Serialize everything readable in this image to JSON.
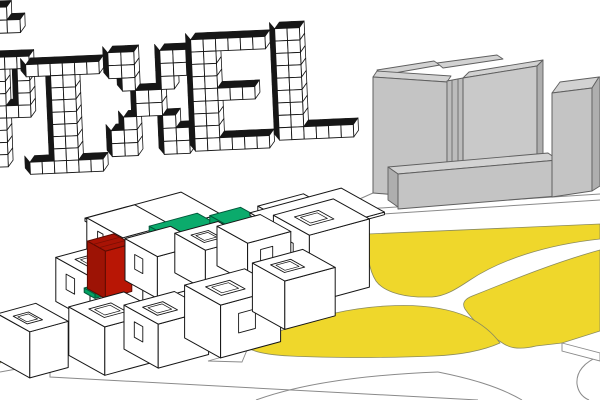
{
  "title": {
    "text": "PIXEL",
    "glyphs": {
      "P": [
        "XXXX",
        "XX.X",
        "XX.X",
        "XX.X",
        "XXXX",
        "XX..",
        "XX..",
        "XX..",
        "XX.."
      ],
      "I": [
        "XXXXXX",
        "..XX..",
        "..XX..",
        "..XX..",
        "..XX..",
        "..XX..",
        "..XX..",
        "..XX..",
        "XXXXXX"
      ],
      "X": [
        "XX..XX",
        "XX..XX",
        ".X..X.",
        "..XX..",
        "..XX..",
        ".X..X.",
        "XX..XX",
        "XX..XX"
      ],
      "E": [
        "XXXXXX",
        "XX....",
        "XX....",
        "XX....",
        "XXXXX.",
        "XX....",
        "XX....",
        "XX....",
        "XXXXXX"
      ],
      "L": [
        "XX....",
        "XX....",
        "XX....",
        "XX....",
        "XX....",
        "XX....",
        "XX....",
        "XX....",
        "XXXXXX"
      ]
    },
    "fragment": [
      "X.",
      "XX"
    ]
  },
  "colors": {
    "ink": "#161616",
    "line": "#8a8a8a",
    "lawn": "#efd72b",
    "lawn_edge": "#8b8b5e",
    "gray_top": "#d2d2d2",
    "gray_face": "#c4c4c4",
    "gray_face2": "#c9c9c9",
    "gray_pilaster": "#bcbcbc",
    "gray_side": "#aeaeae",
    "gray_edge": "#5f5f5f",
    "green_top": "#0bab6c",
    "green_front": "#02a061",
    "green_side": "#018a52",
    "green_recess": "#018a52",
    "green_edge": "#02573a",
    "red_top": "#a81305",
    "red_front": "#9d1305",
    "red_side": "#b81605",
    "red_edge": "#5f0b02",
    "white": "#ffffff"
  },
  "scene": {
    "units": [
      {
        "id": "roof-deck-left",
        "color": "white",
        "i": 1.6,
        "j": -0.55,
        "k": 1.75,
        "si": 2.0,
        "sj": 1.1,
        "sk": 0.07
      },
      {
        "id": "module-back-left",
        "color": "white",
        "i": 1.3,
        "j": -0.1,
        "k": 1.0,
        "si": 1.0,
        "sj": 1.0,
        "sk": 1.12,
        "window": "front-narrow"
      },
      {
        "id": "unit-green-annex",
        "color": "green",
        "i": 2.1,
        "j": 0.2,
        "k": 0.8,
        "si": 0.45,
        "sj": 0.6,
        "sk": 0.5
      },
      {
        "id": "unit-green-1",
        "color": "green",
        "i": 2.45,
        "j": 0.1,
        "k": 0.78,
        "si": 1.0,
        "sj": 0.9,
        "sk": 0.9,
        "window": "right-big"
      },
      {
        "id": "unit-green-2",
        "color": "green",
        "i": 3.6,
        "j": 0.25,
        "k": 0.6,
        "si": 0.64,
        "sj": 0.8,
        "sk": 1.05
      },
      {
        "id": "unit-green-3",
        "color": "green",
        "i": 4.25,
        "j": 0.3,
        "k": 0.6,
        "si": 0.6,
        "sj": 0.75,
        "sk": 0.62,
        "roof": "recessed"
      },
      {
        "id": "module-back-right",
        "color": "white",
        "i": 4.9,
        "j": -0.15,
        "k": 0.35,
        "si": 0.95,
        "sj": 0.9,
        "sk": 0.95,
        "roof": "open"
      },
      {
        "id": "roof-deck-right",
        "color": "white",
        "i": 5.0,
        "j": -0.5,
        "k": 0.9,
        "si": 1.9,
        "sj": 1.2,
        "sk": 0.06
      },
      {
        "id": "module-right-top",
        "color": "white",
        "i": 5.0,
        "j": 0.15,
        "k": -0.35,
        "si": 1.25,
        "sj": 1.0,
        "sk": 1.55,
        "window": "front-small",
        "roof": "open"
      },
      {
        "id": "module-mid-left",
        "color": "white",
        "i": 0.28,
        "j": 0.4,
        "k": 0.75,
        "si": 1.1,
        "sj": 0.95,
        "sk": 1.0,
        "window": "front-small",
        "roof": "open"
      },
      {
        "id": "unit-green-patch",
        "color": "green",
        "i": 0.78,
        "j": 0.52,
        "k": 0.86,
        "si": 0.16,
        "sj": 0.3,
        "sk": 0.1
      },
      {
        "id": "unit-red",
        "color": "red",
        "i": 0.9,
        "j": 0.45,
        "k": 0.88,
        "si": 0.55,
        "sj": 0.5,
        "sk": 1.08
      },
      {
        "id": "module-mid-2",
        "color": "white",
        "i": 1.72,
        "j": 0.4,
        "k": 0.8,
        "si": 0.95,
        "sj": 0.9,
        "sk": 0.95,
        "window": "front-small"
      },
      {
        "id": "module-mid-3",
        "color": "white",
        "i": 2.72,
        "j": 0.45,
        "k": 0.7,
        "si": 0.9,
        "sj": 0.85,
        "sk": 0.9,
        "roof": "open"
      },
      {
        "id": "module-mid-4",
        "color": "white",
        "i": 3.6,
        "j": 0.45,
        "k": 0.6,
        "si": 0.9,
        "sj": 0.85,
        "sk": 0.9,
        "window": "right-small"
      },
      {
        "id": "module-front-0",
        "color": "white",
        "i": 0.1,
        "j": 1.0,
        "k": -0.15,
        "si": 1.15,
        "sj": 1.0,
        "sk": 1.1,
        "roof": "open"
      },
      {
        "id": "module-front-left",
        "color": "white",
        "i": -1.35,
        "j": 0.95,
        "k": 0.15,
        "si": 0.8,
        "sj": 0.9,
        "sk": 1.05,
        "roof": "open"
      },
      {
        "id": "module-front-1",
        "color": "white",
        "i": 1.25,
        "j": 1.0,
        "k": -0.35,
        "si": 1.05,
        "sj": 0.95,
        "sk": 1.0,
        "roof": "open",
        "window": "front-small"
      },
      {
        "id": "module-front-2",
        "color": "white",
        "i": 2.55,
        "j": 0.95,
        "k": -0.5,
        "si": 1.25,
        "sj": 1.0,
        "sk": 1.2,
        "window": "right-small",
        "roof": "open"
      },
      {
        "id": "module-front-3",
        "color": "white",
        "i": 4.0,
        "j": 0.9,
        "k": -0.35,
        "si": 1.05,
        "sj": 0.9,
        "sk": 1.1,
        "roof": "open"
      }
    ]
  }
}
